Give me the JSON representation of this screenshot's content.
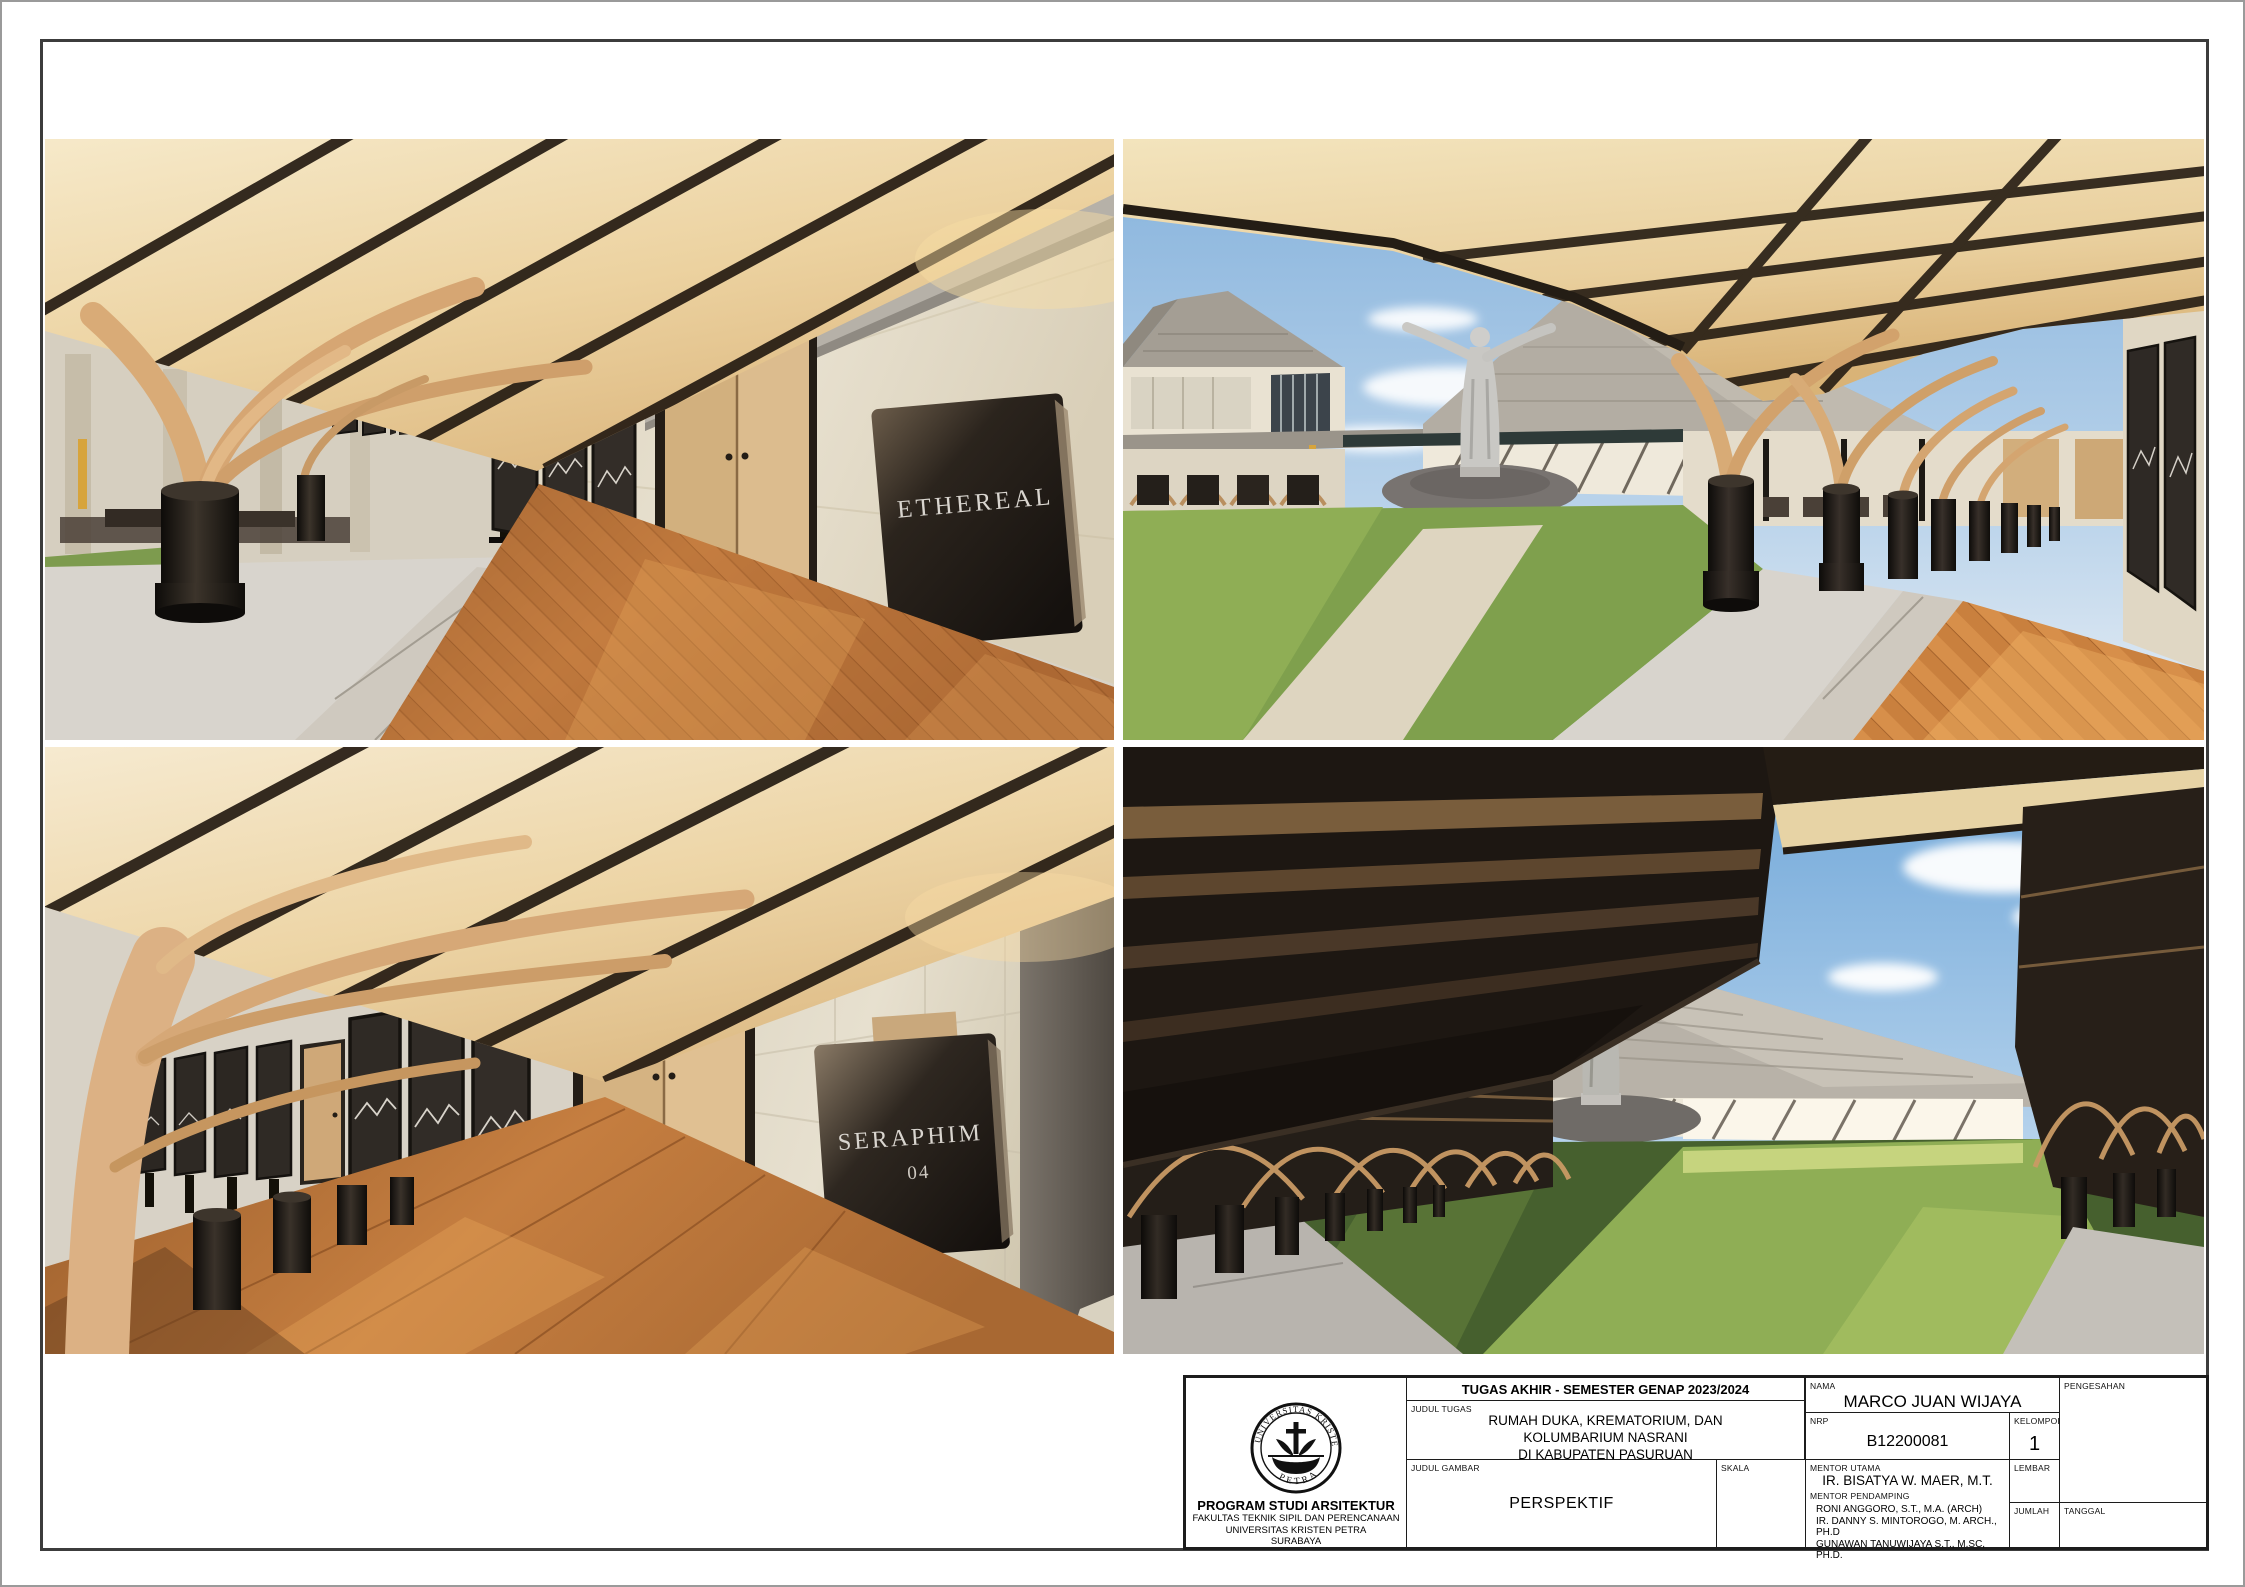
{
  "signs": {
    "ethereal": "ETHEREAL",
    "seraphim_line1": "SERAPHIM",
    "seraphim_line2": "04"
  },
  "title_block": {
    "header": "TUGAS AKHIR - SEMESTER GENAP 2023/2024",
    "labels": {
      "judul_tugas": "JUDUL TUGAS",
      "judul_gambar": "JUDUL GAMBAR",
      "skala": "SKALA",
      "nama": "NAMA",
      "nrp": "NRP",
      "kelompok": "KELOMPOK",
      "mentor_utama": "MENTOR UTAMA",
      "mentor_pendamping": "MENTOR PENDAMPING",
      "lembar": "LEMBAR",
      "jumlah": "JUMLAH",
      "pengesahan": "PENGESAHAN",
      "tanggal": "TANGGAL"
    },
    "values": {
      "judul_tugas_line1": "RUMAH DUKA, KREMATORIUM, DAN",
      "judul_tugas_line2": "KOLUMBARIUM NASRANI",
      "judul_tugas_line3": "DI KABUPATEN PASURUAN",
      "judul_gambar": "PERSPEKTIF",
      "skala": "",
      "nama": "MARCO JUAN WIJAYA",
      "nrp": "B12200081",
      "kelompok": "1",
      "mentor_utama": "IR. BISATYA W. MAER, M.T.",
      "mentor_pendamping_1": "RONI ANGGORO, S.T., M.A. (ARCH)",
      "mentor_pendamping_2": "IR. DANNY S. MINTOROGO, M. ARCH., PH.D",
      "mentor_pendamping_3": "GUNAWAN TANUWIJAYA S.T., M.SC, PH.D.",
      "lembar": "",
      "jumlah": "",
      "pengesahan": "",
      "tanggal": ""
    },
    "institution": {
      "logo_arc_top": "UNIVERSITAS KRISTEN",
      "logo_arc_bottom": "PETRA",
      "program": "PROGRAM STUDI ARSITEKTUR",
      "fakultas": "FAKULTAS TEKNIK SIPIL DAN PERENCANAAN",
      "universitas": "UNIVERSITAS KRISTEN PETRA",
      "kota": "SURABAYA"
    }
  },
  "colors": {
    "sheet_border": "#3c3c3c",
    "table_line": "#1c1c1c",
    "sign_text_silver": "#d9d5cf",
    "sky_blue": "#8fb8e0",
    "canopy_cream": "#ecd3a2",
    "wood_floor_orange": "#c07a3e",
    "travertine": "#e2dac8",
    "grass_green": "#7d9b4e",
    "panel_dark": "#2c2723"
  }
}
